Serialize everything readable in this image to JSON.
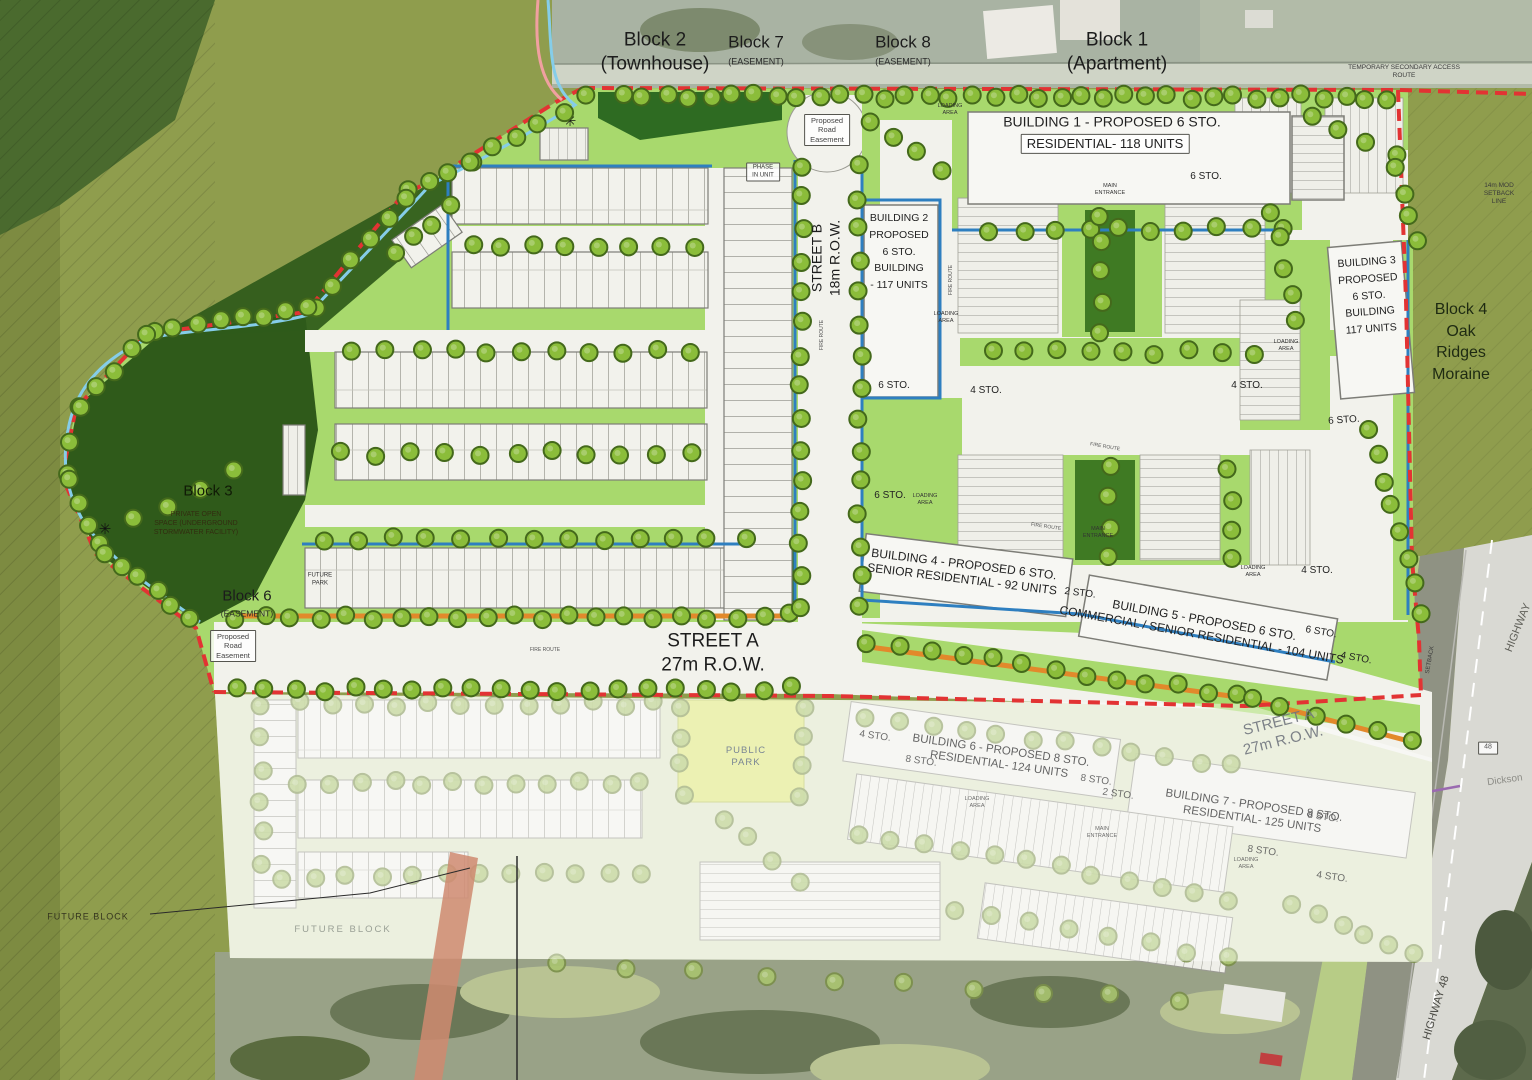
{
  "palette": {
    "boundary_red": "#e23333",
    "stream_blue": "#85cde9",
    "edge_blue": "#2e7fc0",
    "landscape_green": "#a8d96d",
    "dark_forest_green": "#2f5a1a",
    "olive_field": "#8f9d4d",
    "fire_route_orange": "#e2892b",
    "park_yellow": "#dfe77c",
    "tree_green": "#8bbd3a",
    "street_white": "#f2f2ec"
  },
  "map_labels": [
    {
      "name": "block-2-label",
      "text": "Block 2\n(Townhouse)",
      "x": 655,
      "y": 52,
      "fs": 19,
      "color": "#1c1c1c"
    },
    {
      "name": "block-7-label",
      "text": "Block 7",
      "x": 756,
      "y": 42,
      "fs": 17,
      "color": "#1c1c1c"
    },
    {
      "name": "block-7-sub-label",
      "text": "(EASEMENT)",
      "x": 756,
      "y": 62,
      "fs": 9,
      "color": "#2a2a2a"
    },
    {
      "name": "block-8-label",
      "text": "Block 8",
      "x": 903,
      "y": 42,
      "fs": 17,
      "color": "#1c1c1c"
    },
    {
      "name": "block-8-sub-label",
      "text": "(EASEMENT)",
      "x": 903,
      "y": 62,
      "fs": 9,
      "color": "#2a2a2a"
    },
    {
      "name": "block-1-label",
      "text": "Block 1\n(Apartment)",
      "x": 1117,
      "y": 52,
      "fs": 19,
      "color": "#1c1c1c"
    },
    {
      "name": "temporary-access-route-label",
      "text": "TEMPORARY SECONDARY ACCESS ROUTE",
      "x": 1404,
      "y": 72,
      "fs": 6.5,
      "color": "#3a3a3a"
    },
    {
      "name": "setback-line-label",
      "text": "14m MOD\nSETBACK LINE",
      "x": 1499,
      "y": 194,
      "fs": 6.5,
      "color": "#3a3a3a"
    },
    {
      "name": "building-1-title",
      "text": "BUILDING 1 - PROPOSED 6 STO.",
      "x": 1112,
      "y": 122,
      "fs": 14,
      "color": "#222222"
    },
    {
      "name": "building-1-units",
      "text": "RESIDENTIAL- 118 UNITS",
      "x": 1105,
      "y": 144,
      "fs": 13,
      "color": "#222222",
      "box": true
    },
    {
      "name": "storeys-label",
      "text": "6 STO.",
      "x": 1206,
      "y": 177,
      "fs": 10,
      "color": "#222222"
    },
    {
      "name": "main-entrance-label",
      "text": "MAIN\nENTRANCE",
      "x": 1110,
      "y": 190,
      "fs": 5.5,
      "color": "#333333"
    },
    {
      "name": "loading-area-label",
      "text": "LOADING\nAREA",
      "x": 950,
      "y": 110,
      "fs": 5.5,
      "color": "#333333"
    },
    {
      "name": "building-2-label",
      "text": "BUILDING 2\nPROPOSED\n6 STO.\nBUILDING\n- 117 UNITS",
      "x": 899,
      "y": 252,
      "fs": 10.5,
      "color": "#222222",
      "lh": 1.6
    },
    {
      "name": "building-3-label",
      "text": "BUILDING 3\nPROPOSED\n6 STO.\nBUILDING\n117 UNITS",
      "x": 1369,
      "y": 296,
      "fs": 10.5,
      "color": "#222222",
      "rot": -4,
      "lh": 1.6
    },
    {
      "name": "block-4-label",
      "text": "Block 4\nOak Ridges\nMoraine",
      "x": 1461,
      "y": 342,
      "fs": 16,
      "color": "#1e2a12",
      "lh": 1.35
    },
    {
      "name": "block-3-label",
      "text": "Block 3",
      "x": 208,
      "y": 492,
      "fs": 15,
      "color": "#101b06"
    },
    {
      "name": "block-3-sub-label",
      "text": "PRIVATE OPEN\nSPACE (UNDERGROUND\nSTORMWATER FACILITY)",
      "x": 196,
      "y": 524,
      "fs": 7,
      "color": "#33250f",
      "op": 0.85
    },
    {
      "name": "block-6-label",
      "text": "Block 6",
      "x": 247,
      "y": 597,
      "fs": 15,
      "color": "#1c1c1c"
    },
    {
      "name": "block-6-sub-label",
      "text": "(EASEMENT)",
      "x": 247,
      "y": 614,
      "fs": 8.5,
      "color": "#2a2a2a"
    },
    {
      "name": "proposed-road-easement-label",
      "text": "Proposed\nRoad\nEasement",
      "x": 233,
      "y": 646,
      "fs": 7.5,
      "color": "#444444",
      "box": true
    },
    {
      "name": "future-park-label",
      "text": "FUTURE\nPARK",
      "x": 320,
      "y": 580,
      "fs": 6,
      "color": "#2e2e2e"
    },
    {
      "name": "street-a-label",
      "text": "STREET A\n27m R.O.W.",
      "x": 713,
      "y": 653,
      "fs": 19,
      "color": "#1c1c1c"
    },
    {
      "name": "street-b-label",
      "text": "STREET B\n18m R.O.W.",
      "x": 826,
      "y": 258,
      "fs": 14,
      "color": "#1c1c1c",
      "rot": -90
    },
    {
      "name": "road-easement-circle-label",
      "text": "Proposed\nRoad\nEasement",
      "x": 827,
      "y": 130,
      "fs": 7.5,
      "color": "#444444",
      "box": true
    },
    {
      "name": "phase-in-unit-label",
      "text": "PHASE\nIN UNIT",
      "x": 763,
      "y": 172,
      "fs": 6,
      "color": "#333333",
      "box": true
    },
    {
      "name": "building-4-label",
      "text": "BUILDING 4 - PROPOSED 6 STO.\nSENIOR RESIDENTIAL - 92 UNITS",
      "x": 963,
      "y": 572,
      "fs": 12,
      "color": "#222222",
      "rot": 7
    },
    {
      "name": "building-5-label",
      "text": "BUILDING 5 - PROPOSED 6 STO.\nCOMMERCIAL / SENIOR RESIDENTIAL - 104 UNITS",
      "x": 1203,
      "y": 628,
      "fs": 12,
      "color": "#222222",
      "rot": 10
    },
    {
      "name": "storeys-label",
      "text": "6 STO.",
      "x": 894,
      "y": 386,
      "fs": 10,
      "color": "#222222"
    },
    {
      "name": "storeys-label",
      "text": "4 STO.",
      "x": 986,
      "y": 391,
      "fs": 10,
      "color": "#222222"
    },
    {
      "name": "storeys-label",
      "text": "4 STO.",
      "x": 1247,
      "y": 386,
      "fs": 10,
      "color": "#222222"
    },
    {
      "name": "storeys-label",
      "text": "6 STO.",
      "x": 1344,
      "y": 421,
      "fs": 10,
      "color": "#222222",
      "rot": -4
    },
    {
      "name": "storeys-label",
      "text": "6 STO.",
      "x": 890,
      "y": 496,
      "fs": 10,
      "color": "#222222"
    },
    {
      "name": "storeys-label",
      "text": "2 STO.",
      "x": 1080,
      "y": 594,
      "fs": 10,
      "color": "#222222",
      "rot": 7
    },
    {
      "name": "storeys-label",
      "text": "4 STO.",
      "x": 1317,
      "y": 571,
      "fs": 10,
      "color": "#222222"
    },
    {
      "name": "storeys-label",
      "text": "6 STO.",
      "x": 1321,
      "y": 633,
      "fs": 10,
      "color": "#222222",
      "rot": 10
    },
    {
      "name": "storeys-label",
      "text": "4 STO.",
      "x": 1356,
      "y": 659,
      "fs": 10,
      "color": "#222222",
      "rot": 10
    },
    {
      "name": "loading-area-label",
      "text": "LOADING\nAREA",
      "x": 946,
      "y": 318,
      "fs": 5.5,
      "color": "#333333"
    },
    {
      "name": "loading-area-label",
      "text": "LOADING\nAREA",
      "x": 1286,
      "y": 346,
      "fs": 5.5,
      "color": "#333333"
    },
    {
      "name": "loading-area-label",
      "text": "LOADING\nAREA",
      "x": 925,
      "y": 500,
      "fs": 5.5,
      "color": "#333333"
    },
    {
      "name": "loading-area-label",
      "text": "LOADING\nAREA",
      "x": 1253,
      "y": 572,
      "fs": 5.5,
      "color": "#333333"
    },
    {
      "name": "main-entrance-label",
      "text": "MAIN\nENTRANCE",
      "x": 1098,
      "y": 533,
      "fs": 5.5,
      "color": "#333333"
    },
    {
      "name": "fire-route-label",
      "text": "FIRE ROUTE",
      "x": 545,
      "y": 650,
      "fs": 5,
      "color": "#555555"
    },
    {
      "name": "fire-route-label",
      "text": "FIRE ROUTE",
      "x": 951,
      "y": 280,
      "fs": 5,
      "color": "#555555",
      "rot": -90
    },
    {
      "name": "fire-route-label",
      "text": "FIRE ROUTE",
      "x": 822,
      "y": 335,
      "fs": 5,
      "color": "#555555",
      "rot": -90
    },
    {
      "name": "fire-route-label",
      "text": "FIRE ROUTE",
      "x": 1105,
      "y": 447,
      "fs": 5,
      "color": "#555555",
      "rot": 10
    },
    {
      "name": "fire-route-label",
      "text": "FIRE ROUTE",
      "x": 1046,
      "y": 527,
      "fs": 5,
      "color": "#555555",
      "rot": 8
    },
    {
      "name": "building-6-label",
      "text": "BUILDING 6 - PROPOSED 8 STO.\nRESIDENTIAL- 124 UNITS",
      "x": 1000,
      "y": 758,
      "fs": 11.5,
      "color": "#4a4a4a",
      "rot": 8,
      "op": 0.85
    },
    {
      "name": "storeys-label",
      "text": "8 STO.",
      "x": 921,
      "y": 762,
      "fs": 10,
      "color": "#555555",
      "rot": 8,
      "op": 0.85
    },
    {
      "name": "storeys-label",
      "text": "8 STO.",
      "x": 1096,
      "y": 781,
      "fs": 10,
      "color": "#555555",
      "rot": 8,
      "op": 0.85
    },
    {
      "name": "storeys-label",
      "text": "2 STO.",
      "x": 1118,
      "y": 795,
      "fs": 10,
      "color": "#555555",
      "rot": 8,
      "op": 0.85
    },
    {
      "name": "storeys-label",
      "text": "4 STO.",
      "x": 875,
      "y": 737,
      "fs": 10,
      "color": "#555555",
      "rot": 8,
      "op": 0.85
    },
    {
      "name": "building-7-label",
      "text": "BUILDING 7 - PROPOSED 8 STO.\nRESIDENTIAL- 125 UNITS",
      "x": 1253,
      "y": 813,
      "fs": 11.5,
      "color": "#4a4a4a",
      "rot": 8,
      "op": 0.85
    },
    {
      "name": "storeys-label",
      "text": "8 STO.",
      "x": 1323,
      "y": 818,
      "fs": 10,
      "color": "#555555",
      "rot": 8,
      "op": 0.85
    },
    {
      "name": "storeys-label",
      "text": "8 STO.",
      "x": 1263,
      "y": 852,
      "fs": 10,
      "color": "#555555",
      "rot": 8,
      "op": 0.85
    },
    {
      "name": "storeys-label",
      "text": "4 STO.",
      "x": 1332,
      "y": 878,
      "fs": 10,
      "color": "#555555",
      "rot": 8,
      "op": 0.85
    },
    {
      "name": "loading-area-label",
      "text": "LOADING\nAREA",
      "x": 977,
      "y": 803,
      "fs": 5.5,
      "color": "#555555",
      "op": 0.85
    },
    {
      "name": "loading-area-label",
      "text": "LOADING\nAREA",
      "x": 1246,
      "y": 864,
      "fs": 5.5,
      "color": "#555555",
      "op": 0.85
    },
    {
      "name": "main-entrance-label",
      "text": "MAIN\nENTRANCE",
      "x": 1102,
      "y": 833,
      "fs": 5.5,
      "color": "#555555",
      "op": 0.85
    },
    {
      "name": "public-park-label",
      "text": "PUBLIC\nPARK",
      "x": 746,
      "y": 757,
      "fs": 9.5,
      "color": "#7a8694",
      "ls": 1
    },
    {
      "name": "street-a-2-label",
      "text": "STREET A\n27m R.O.W.",
      "x": 1281,
      "y": 732,
      "fs": 15,
      "color": "#70757e",
      "rot": -14,
      "op": 0.9
    },
    {
      "name": "future-block-west-label",
      "text": "FUTURE BLOCK",
      "x": 88,
      "y": 917,
      "fs": 9,
      "color": "#36361f",
      "ls": 1
    },
    {
      "name": "future-block-south-label",
      "text": "FUTURE BLOCK",
      "x": 343,
      "y": 930,
      "fs": 9.5,
      "color": "#9aa096",
      "ls": 2
    },
    {
      "name": "highway-label",
      "text": "HIGHWAY",
      "x": 1519,
      "y": 628,
      "fs": 11,
      "color": "#5f5f58",
      "rot": -68
    },
    {
      "name": "dickson-label",
      "text": "Dickson",
      "x": 1505,
      "y": 781,
      "fs": 10,
      "color": "#8c8c86",
      "rot": -8
    },
    {
      "name": "highway-48-shield",
      "text": "48",
      "x": 1488,
      "y": 748,
      "fs": 7,
      "color": "#555555",
      "box": true
    },
    {
      "name": "highway-48-label",
      "text": "HIGHWAY 48",
      "x": 1437,
      "y": 1008,
      "fs": 11,
      "color": "#4a4a44",
      "rot": -73
    },
    {
      "name": "setback-rot-label",
      "text": "SETBACK",
      "x": 1431,
      "y": 660,
      "fs": 6,
      "color": "#3a3a3a",
      "rot": -80
    }
  ]
}
